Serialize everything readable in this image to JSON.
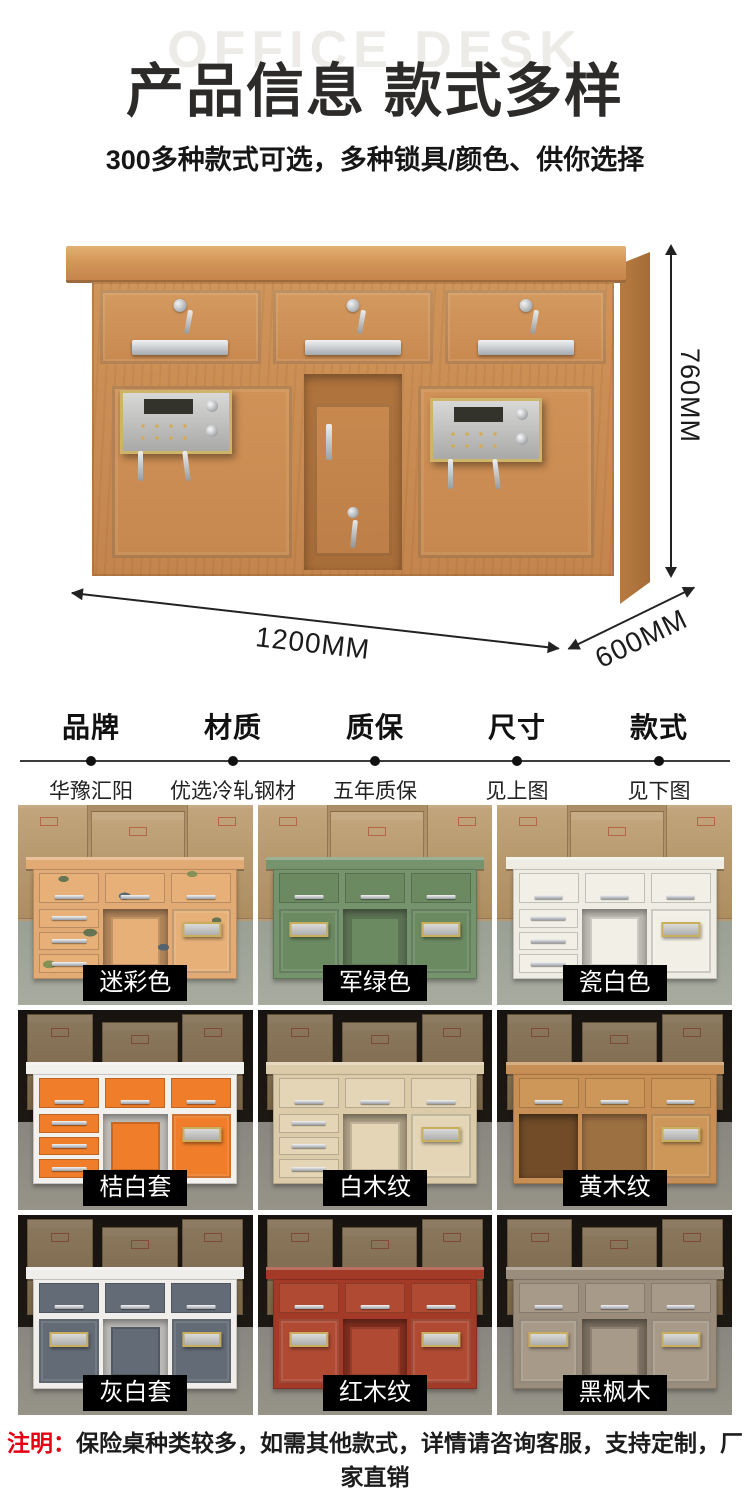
{
  "header": {
    "watermark": "OFFICE DESK",
    "title": "产品信息 款式多样",
    "subtitle": "300多种款式可选，多种锁具/颜色、供你选择"
  },
  "hero": {
    "dimensions": {
      "height": "760MM",
      "width": "1200MM",
      "depth": "600MM"
    }
  },
  "specs": {
    "columns": [
      {
        "label": "品牌",
        "value": "华豫汇阳"
      },
      {
        "label": "材质",
        "value": "优选冷轧钢材"
      },
      {
        "label": "质保",
        "value": "五年质保"
      },
      {
        "label": "尺寸",
        "value": "见上图"
      },
      {
        "label": "款式",
        "value": "见下图"
      }
    ]
  },
  "variants": [
    {
      "label": "迷彩色",
      "layout": "drawers-left",
      "locks": "right",
      "bg": "light",
      "camo": true,
      "colors": {
        "frame": "#e2aa74",
        "panel": "#e6b078"
      }
    },
    {
      "label": "军绿色",
      "layout": "doors",
      "locks": "both",
      "bg": "light",
      "camo": false,
      "colors": {
        "frame": "#75936c",
        "panel": "#6b8a62"
      }
    },
    {
      "label": "瓷白色",
      "layout": "drawers-left",
      "locks": "right",
      "bg": "light",
      "camo": false,
      "colors": {
        "frame": "#efede3",
        "panel": "#f2f0e6"
      }
    },
    {
      "label": "桔白套",
      "layout": "drawers-left",
      "locks": "right",
      "bg": "dark",
      "camo": false,
      "colors": {
        "frame": "#f3f1ed",
        "panel": "#ef7d2a"
      }
    },
    {
      "label": "白木纹",
      "layout": "drawers-left",
      "locks": "right",
      "bg": "dark",
      "camo": false,
      "colors": {
        "frame": "#dbcba9",
        "panel": "#e3d5b5"
      }
    },
    {
      "label": "黄木纹",
      "layout": "open-left",
      "locks": "right",
      "bg": "dark",
      "camo": false,
      "colors": {
        "frame": "#c78f55",
        "panel": "#cd9759"
      }
    },
    {
      "label": "灰白套",
      "layout": "doors",
      "locks": "both",
      "bg": "dark",
      "camo": false,
      "colors": {
        "frame": "#efeeea",
        "panel": "#636b76"
      }
    },
    {
      "label": "红木纹",
      "layout": "doors",
      "locks": "both",
      "bg": "dark",
      "camo": false,
      "colors": {
        "frame": "#a33a28",
        "panel": "#b04a33"
      }
    },
    {
      "label": "黑枫木",
      "layout": "doors",
      "locks": "both",
      "bg": "dark",
      "camo": false,
      "colors": {
        "frame": "#9b8d7c",
        "panel": "#a89a89"
      }
    }
  ],
  "note": {
    "prefix": "注明：",
    "text": "保险桌种类较多，如需其他款式，详情请咨询客服，支持定制，厂家直销"
  },
  "colors": {
    "accent_red": "#e60012",
    "title_text": "#2d2b2a",
    "tag_bg": "#000000",
    "tag_text": "#ffffff"
  }
}
